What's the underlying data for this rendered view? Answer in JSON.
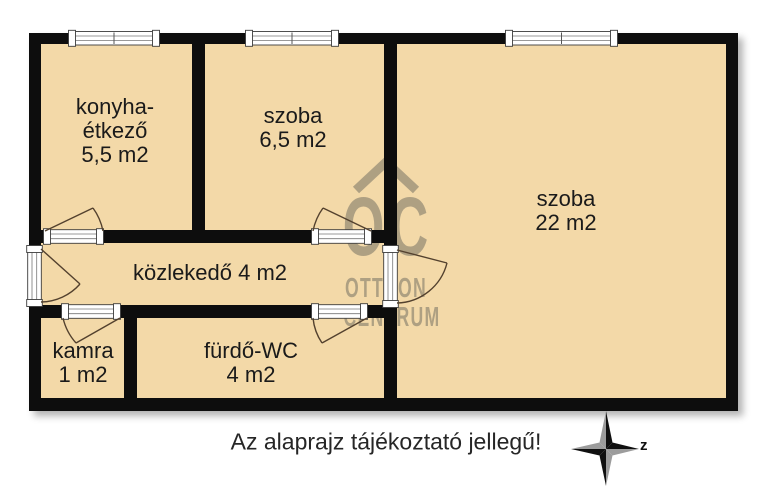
{
  "caption": "Az alaprajz tájékoztató jellegű!",
  "plan": {
    "rooms": {
      "konyha": {
        "lines": [
          "konyha-",
          "étkező",
          "5,5 m2"
        ]
      },
      "szoba_kis": {
        "lines": [
          "szoba",
          "6,5 m2"
        ]
      },
      "szoba_nagy": {
        "lines": [
          "szoba",
          "22 m2"
        ]
      },
      "kozlekedo": {
        "lines": [
          "közlekedő 4 m2"
        ]
      },
      "kamra": {
        "lines": [
          "kamra",
          "1 m2"
        ]
      },
      "furdo_wc": {
        "lines": [
          "fürdő-WC",
          "4 m2"
        ]
      }
    }
  },
  "watermark": {
    "logo_text": "OC",
    "line1": "OTTHON",
    "line2": "CENTRUM"
  },
  "compass": {
    "north_label": "z"
  },
  "colors": {
    "floor": "#f3d9a8",
    "wall": "#0d0d0d",
    "watermark": "#6b685e"
  }
}
